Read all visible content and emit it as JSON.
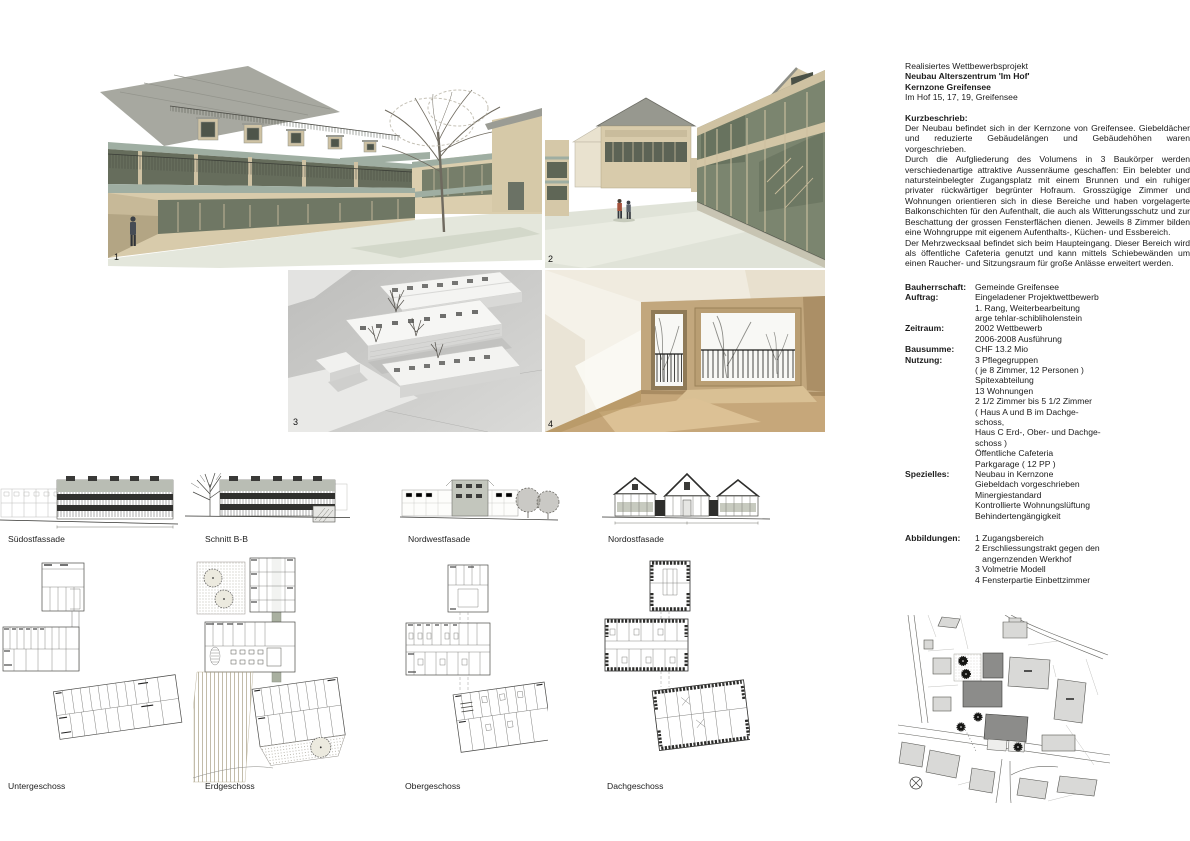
{
  "figures": {
    "fig1": {
      "number": "1"
    },
    "fig2": {
      "number": "2"
    },
    "fig3": {
      "number": "3"
    },
    "fig4": {
      "number": "4"
    }
  },
  "elevations": {
    "labels": [
      "Südostfassade",
      "Schnitt B-B",
      "Nordwestfasade",
      "Nordostfasade"
    ]
  },
  "plans": {
    "labels": [
      "Untergeschoss",
      "Erdgeschoss",
      "Obergeschoss",
      "Dachgeschoss"
    ]
  },
  "info": {
    "header": {
      "line1": "Realisiertes Wettbewerbsprojekt",
      "line2": "Neubau Alterszentrum 'Im Hof'",
      "line3": "Kernzone Greifensee",
      "line4": "Im Hof 15, 17, 19,  Greifensee"
    },
    "kurzbeschrieb_heading": "Kurzbeschrieb:",
    "paragraphs": [
      "Der Neubau befindet sich in der Kernzone von Greifensee. Giebeldächer und reduzierte Gebäudelängen und Gebäudehöhen waren vorgeschrieben.",
      "Durch die Aufgliederung des Volumens in 3 Baukörper werden verschiedenartige attraktive Aussenräume geschaffen: Ein belebter und natursteinbelegter Zugangsplatz mit einem Brunnen und ein ruhiger privater rückwärtiger begrünter Hofraum. Grosszügige Zimmer und Wohnungen orientieren sich in diese Bereiche und haben vorgelagerte Balkonschichten für den Aufenthalt, die auch als Witterungsschutz und zur Beschattung der grossen Fensterflächen dienen. Jeweils 8 Zimmer bilden eine Wohngruppe mit eigenem Aufenthalts-, Küchen- und Essbereich.",
      "Der Mehrzwecksaal befindet sich beim Haupteingang. Dieser Bereich wird als öffentliche Cafeteria genutzt und kann mittels Schiebewänden um einen Raucher- und Sitzungsraum  für große Anlässe erweitert werden."
    ],
    "details": [
      {
        "label": "Bauherrschaft:",
        "lines": [
          "Gemeinde Greifensee"
        ]
      },
      {
        "label": "Auftrag:",
        "lines": [
          "Eingeladener Projektwettbewerb",
          "1. Rang, Weiterbearbeitung",
          "arge tehlar-schibliholenstein"
        ]
      },
      {
        "label": "Zeitraum:",
        "lines": [
          "2002 Wettbewerb",
          "2006-2008 Ausführung"
        ]
      },
      {
        "label": "Bausumme:",
        "lines": [
          "CHF 13.2 Mio"
        ]
      },
      {
        "label": "Nutzung:",
        "lines": [
          "3 Pflegegruppen",
          "( je 8 Zimmer, 12 Personen )",
          "Spitexabteilung",
          "13 Wohnungen",
          "2 1/2 Zimmer bis 5 1/2 Zimmer",
          "( Haus A und B im Dachge-",
          "schoss,",
          "Haus C Erd-, Ober- und Dachge-",
          "schoss )",
          "Öffentliche Cafeteria",
          "Parkgarage ( 12 PP )"
        ]
      },
      {
        "label": "Spezielles:",
        "lines": [
          "Neubau in Kernzone",
          "Giebeldach vorgeschrieben",
          "Minergiestandard",
          "Kontrollierte Wohnungslüftung",
          "Behindertengängigkeit"
        ]
      },
      {
        "label": "Abbildungen:",
        "lines": [
          "1 Zugangsbereich",
          "2 Erschliessungstrakt gegen den",
          "   angernzenden Werkhof",
          "3 Volmetrie Modell",
          "4 Fensterpartie Einbettzimmer"
        ]
      }
    ]
  },
  "colors": {
    "facade_beige": "#d8cbab",
    "slab_grey_green": "#9faea2",
    "glass_olive": "#6b7265",
    "plaza_grey_green": "#e0e3d8",
    "model_background_grey": "#c9c9c7",
    "interior_wall_tan": "#c2a77d",
    "interior_floor_tan": "#c6a77a",
    "plan_line_grey": "#4a4a48",
    "siteplan_new_building_grey": "#8c8c8c",
    "siteplan_existing_building_grey": "#d9d9d9"
  }
}
